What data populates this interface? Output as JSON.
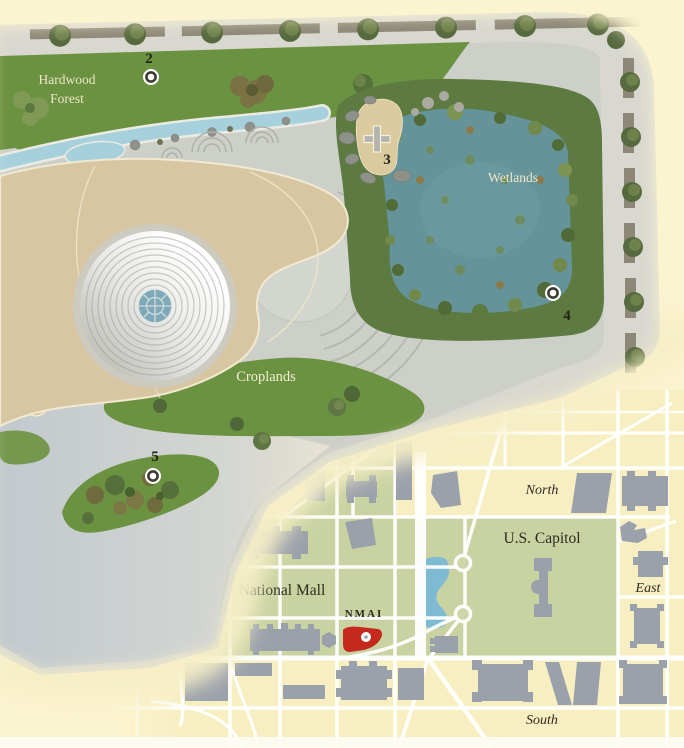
{
  "page": {
    "background_color": "#fbf4d0"
  },
  "site_plan": {
    "labels": {
      "hardwood_forest": [
        "Hardwood",
        "Forest"
      ],
      "wetlands": "Wetlands",
      "croplands": "Croplands"
    },
    "markers": [
      {
        "number": "2",
        "icon": "circle-target"
      },
      {
        "number": "3",
        "icon": "cross"
      },
      {
        "number": "4",
        "icon": "circle-target"
      },
      {
        "number": "5",
        "icon": "circle-target"
      }
    ],
    "colors": {
      "lawn_green": "#6b9240",
      "wetland_vegetation": "#5d7a40",
      "wetland_pond": "#64939a",
      "building_tan": "#d7c6a1",
      "stream_blue": "#a7d0dd",
      "pavement_gray": "#cdcfc9",
      "dome_center_blue": "#7fa9b8"
    }
  },
  "inset_map": {
    "labels": {
      "north": "North",
      "south": "South",
      "east": "East",
      "west": "West",
      "us_capitol": "U.S. Capitol",
      "national_mall": "National Mall",
      "nmai": "NMAI"
    },
    "colors": {
      "parkland_green": "#c9d3a1",
      "street_cream": "#f7efc2",
      "building_gray": "#9ba1ab",
      "water_blue": "#7ebbd3",
      "nmai_red": "#c5281c"
    }
  }
}
